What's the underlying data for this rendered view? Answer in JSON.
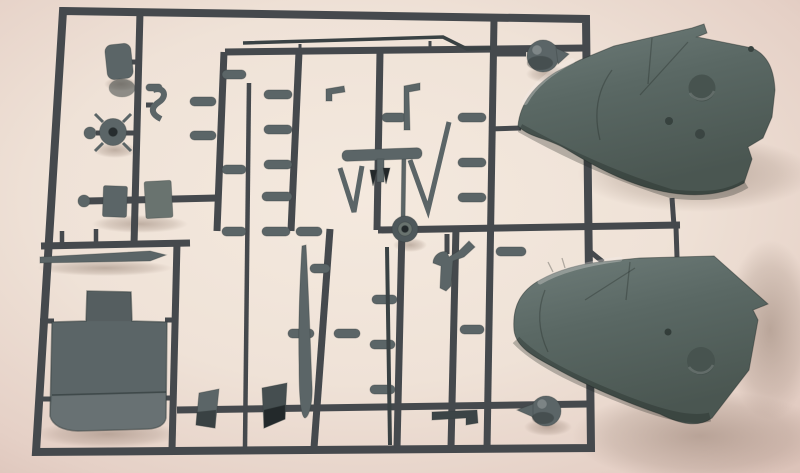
{
  "meta": {
    "type": "photograph",
    "subject": "injection-molded model kit sprue (runner) of grey plastic aircraft parts on a pale pink background",
    "text_visible": "none"
  },
  "palette": {
    "bg_center": "#f4e9de",
    "bg_mid": "#efe2d7",
    "bg_edge": "#e5d0c6",
    "bg_corner": "#dcc3b9",
    "sprue": "#45494d",
    "part": "#5b6567",
    "part_light": "#69736f",
    "part_dark": "#3a4244",
    "cowl_light": "#6f7d7a",
    "cowl_mid": "#5a6864",
    "cowl_dark": "#4a5651",
    "recess": "#47534f",
    "shadow": "#7a6456",
    "highlight": "#f7f2ec"
  },
  "parts": [
    {
      "name": "sprue-frame",
      "description": "rectangular dark grey runner frame with internal vertical and horizontal runners"
    },
    {
      "name": "engine-cowling-top",
      "description": "large grey engine cowling half, nose left, attached upper right"
    },
    {
      "name": "engine-cowling-bottom",
      "description": "large grey engine cowling half, nose left, attached lower right"
    },
    {
      "name": "cockpit-floor-part",
      "description": "large flat stepped plate with curved lower edge, lower left"
    },
    {
      "name": "seat-part",
      "description": "small rounded seat back, upper left"
    },
    {
      "name": "exhaust-part",
      "description": "small S-shaped part"
    },
    {
      "name": "control-wheel-part",
      "description": "round hub with radial spikes and small ball"
    },
    {
      "name": "block-part",
      "description": "two small rectangular blocks on a horizontal runner"
    },
    {
      "name": "bomb-part",
      "description": "many small pill-shaped parts attached to vertical runners"
    },
    {
      "name": "strut-v-part",
      "description": "V-shaped struts in the middle of the sprue"
    },
    {
      "name": "t-bar-part",
      "description": "horizontal T-bar part with stem"
    },
    {
      "name": "antenna-rod-part",
      "description": "long thin rod with bent end along the top"
    },
    {
      "name": "propeller-blade-part",
      "description": "long tapered blade, lower middle"
    },
    {
      "name": "tapered-rod-part",
      "description": "long tapered rod under left crossbar"
    },
    {
      "name": "main-wheel-part",
      "description": "small wheel with hub hole at centre"
    },
    {
      "name": "rudder-pedal-part",
      "description": "hook / pedal shaped part"
    },
    {
      "name": "spinner-ball-top",
      "description": "ball shaped part with stub, upper right"
    },
    {
      "name": "spinner-ball-bottom",
      "description": "ball shaped part with tail, lower right"
    },
    {
      "name": "dark-block-part",
      "description": "dark angled block, bottom middle"
    },
    {
      "name": "parallelogram-part",
      "description": "small slanted plate, bottom left of middle"
    }
  ]
}
